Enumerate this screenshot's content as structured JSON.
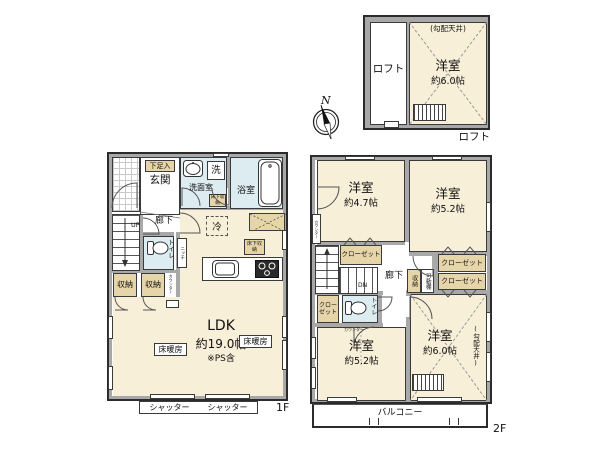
{
  "colors": {
    "wall": "#a8a8a8",
    "floor_cream": "#f8efd8",
    "wet_blue": "#ddecf0",
    "closet_tan": "#e6d5a8",
    "white": "#ffffff"
  },
  "compass": {
    "north": "N"
  },
  "loft": {
    "caption": "ロフト",
    "area_label": "ロフト",
    "room": "洋室",
    "size": "約6.0帖",
    "ceiling": "(勾配天井)"
  },
  "f1": {
    "caption": "1F",
    "genkan": "玄関",
    "shoe_box": "下足入",
    "washroom": "洗面室",
    "washer": "洗",
    "bathroom": "浴室",
    "hallway": "廊下",
    "up": "UP",
    "toilet": "トイレ",
    "niche": "ニッチ",
    "storage_a": "収納",
    "storage_b": "収納",
    "counter": "カウンター",
    "fridge": "冷",
    "underfloor_a": "床下収納",
    "underfloor_b": "床下収納",
    "ldk": "LDK",
    "ldk_size": "約19.0帖",
    "ldk_note": "※PS含",
    "floor_heating_a": "床暖房",
    "floor_heating_b": "床暖房",
    "shutter_a": "シャッター",
    "shutter_b": "シャッター"
  },
  "f2": {
    "caption": "2F",
    "room_nw": {
      "name": "洋室",
      "size": "約4.7帖"
    },
    "room_ne": {
      "name": "洋室",
      "size": "約5.2帖"
    },
    "room_sw": {
      "name": "洋室",
      "size": "約5.2帖"
    },
    "room_se": {
      "name": "洋室",
      "size": "約6.0帖",
      "ceiling": "(勾配天井)"
    },
    "closet_nw": "クローゼット",
    "closet_e1": "クローゼット",
    "closet_e2": "クローゼット",
    "closet_w": "クローゼット",
    "storage": "収納",
    "shelf": "可動棚",
    "hallway": "廊下",
    "dn": "DN",
    "toilet": "トイレ",
    "counter": "カウンター",
    "counter_wall": "カウンター",
    "balcony": "バルコニー"
  }
}
